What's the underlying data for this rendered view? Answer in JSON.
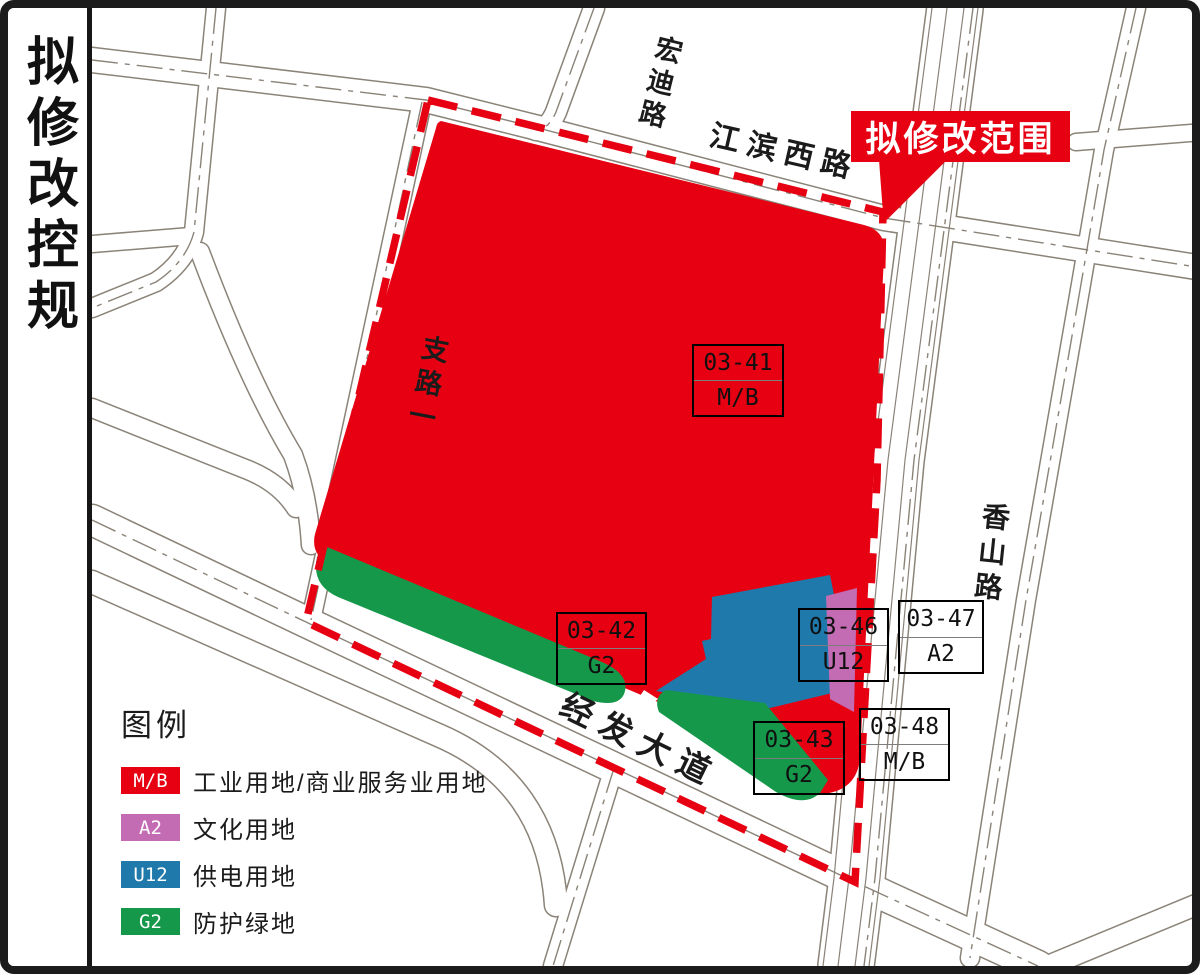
{
  "sidebar": {
    "title": "拟修改控规"
  },
  "banner": {
    "label": "拟修改范围"
  },
  "roads": {
    "hongdi_lu": "宏迪路",
    "jiangbin_xi_lu": "江滨西路",
    "zhi_lu_yi": "支路一",
    "xiangshan_lu": "香山路",
    "jingfa_dadao": "经发大道"
  },
  "parcels": [
    {
      "code": "03-41",
      "use": "M/B"
    },
    {
      "code": "03-42",
      "use": "G2"
    },
    {
      "code": "03-46",
      "use": "U12"
    },
    {
      "code": "03-47",
      "use": "A2"
    },
    {
      "code": "03-43",
      "use": "G2"
    },
    {
      "code": "03-48",
      "use": "M/B"
    }
  ],
  "legend": {
    "title": "图例",
    "items": [
      {
        "code": "M/B",
        "label": "工业用地/商业服务业用地",
        "color": "#e60012"
      },
      {
        "code": "A2",
        "label": "文化用地",
        "color": "#c36cb4"
      },
      {
        "code": "U12",
        "label": "供电用地",
        "color": "#2079ab"
      },
      {
        "code": "G2",
        "label": "防护绿地",
        "color": "#16984a"
      }
    ]
  },
  "colors": {
    "boundary_dash": "#e60012",
    "parcel_mb": "#e60012",
    "parcel_a2": "#c36cb4",
    "parcel_u12": "#2079ab",
    "parcel_g2": "#16984a",
    "road_line": "#8b8378"
  }
}
